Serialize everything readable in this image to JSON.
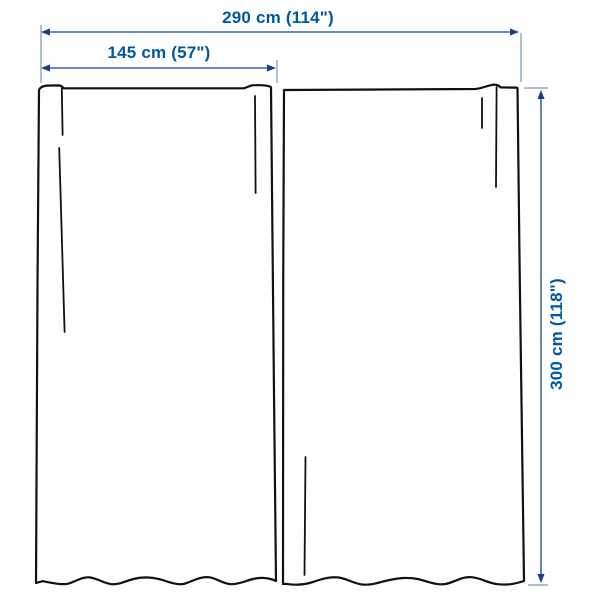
{
  "diagram": {
    "type": "product-dimension-diagram",
    "subject": "pair of curtain panels",
    "labels": {
      "total_width": "290 cm (114\")",
      "panel_width": "145 cm (57\")",
      "height": "300 cm (118\")"
    },
    "colors": {
      "label_text": "#0058a3",
      "dimension_line": "#3a67ab",
      "extension_line": "#8fa6c9",
      "arrow": "#16418c",
      "curtain_outline": "#111111",
      "background": "#ffffff"
    }
  }
}
